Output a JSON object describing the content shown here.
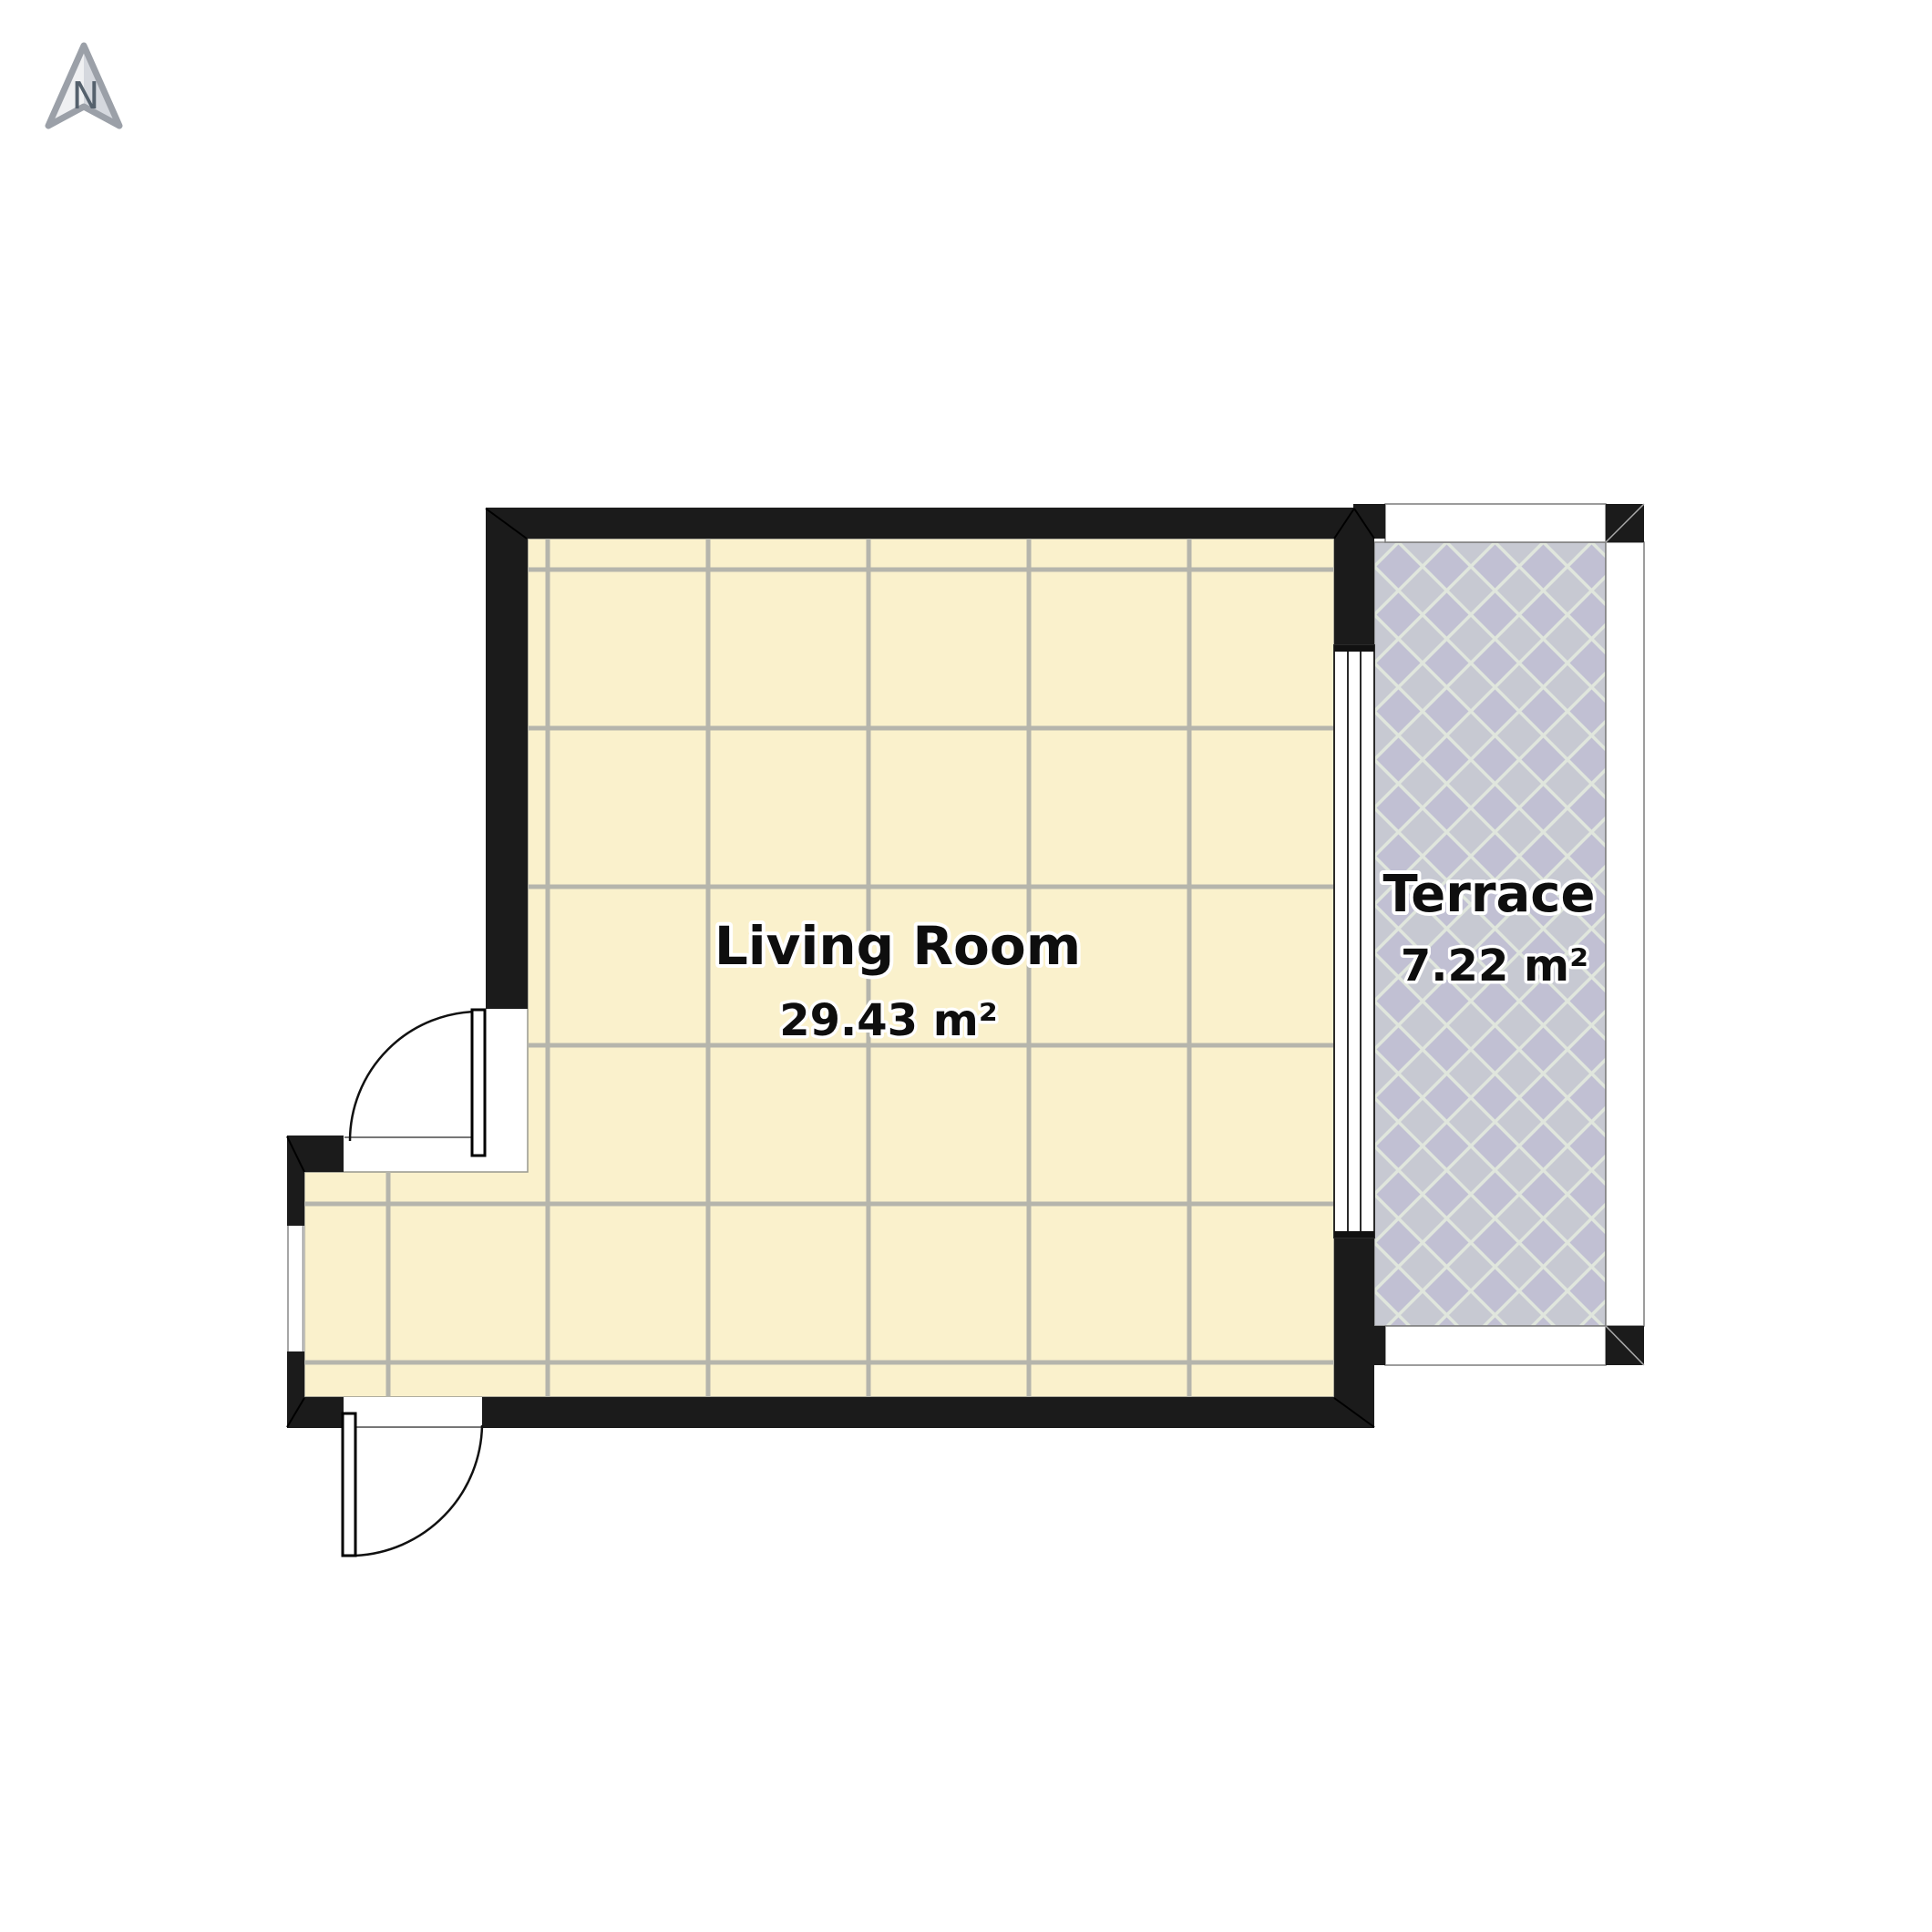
{
  "compass": {
    "label": "N"
  },
  "rooms": [
    {
      "name": "Living Room",
      "area": "29.43 m²"
    },
    {
      "name": "Terrace",
      "area": "7.22 m²"
    }
  ],
  "palette": {
    "wall": "#1b1b1b",
    "living_floor": "#faf1cc",
    "tile_grout": "#b5b5ac",
    "terrace_tile_purple": "#c1c0d3",
    "terrace_tile_gray": "#c7c9d2",
    "terrace_grout": "#e0e6dd",
    "railing_outline": "#7c7c7c",
    "label_text": "#0e0e0e"
  }
}
